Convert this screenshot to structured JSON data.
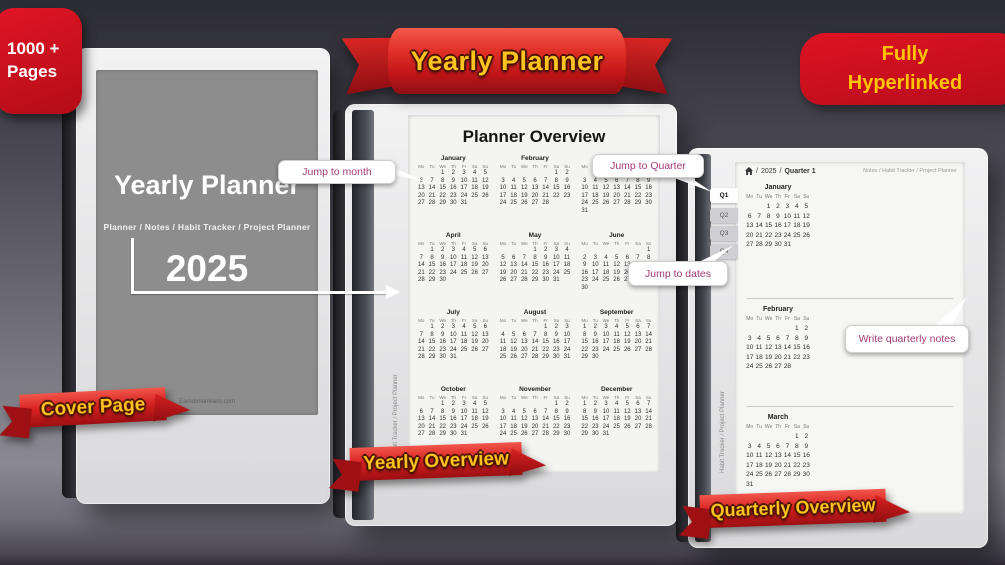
{
  "badge": {
    "line1": "1000 +",
    "line2": "Pages"
  },
  "banner": {
    "label": "Yearly Planner"
  },
  "hyperlink_badge": {
    "line1": "Fully",
    "line2": "Hyperlinked"
  },
  "callouts": {
    "jump_month": "Jump to month",
    "jump_quarter": "Jump to Quarter",
    "jump_dates": "Jump to dates",
    "write_notes": "Write quarterly notes"
  },
  "ribbons": {
    "cover": "Cover Page",
    "yearly": "Yearly Overview",
    "quarterly": "Quarterly Overview"
  },
  "cover": {
    "title": "Yearly Planner",
    "nav": "Planner  /  Notes  /  Habit Tracker  /  Project Planner",
    "year": "2025",
    "watermark": "Earndohanklass.com"
  },
  "overview": {
    "title": "Planner Overview",
    "side_text": "Habit Tracker  /  Project Planner"
  },
  "quarterly": {
    "year": "2025",
    "page": "Quarter 1",
    "sep": "/",
    "links": "Notes / Habit Tracker / Project Planner",
    "tabs": [
      "Q1",
      "Q2",
      "Q3",
      "Q4"
    ],
    "side_text": "Habit Tracker  /  Project Planner"
  },
  "weekdays": [
    "Mo",
    "Tu",
    "We",
    "Th",
    "Fr",
    "Sa",
    "Su"
  ],
  "months": [
    {
      "name": "January",
      "offset": 2,
      "days": 31
    },
    {
      "name": "February",
      "offset": 5,
      "days": 28
    },
    {
      "name": "March",
      "offset": 5,
      "days": 31
    },
    {
      "name": "April",
      "offset": 1,
      "days": 30
    },
    {
      "name": "May",
      "offset": 3,
      "days": 31
    },
    {
      "name": "June",
      "offset": 6,
      "days": 30
    },
    {
      "name": "July",
      "offset": 1,
      "days": 31
    },
    {
      "name": "August",
      "offset": 4,
      "days": 31
    },
    {
      "name": "September",
      "offset": 0,
      "days": 30
    },
    {
      "name": "October",
      "offset": 2,
      "days": 31
    },
    {
      "name": "November",
      "offset": 5,
      "days": 30
    },
    {
      "name": "December",
      "offset": 0,
      "days": 31
    }
  ],
  "colors": {
    "ribbon_red": "#d62020",
    "accent_yellow": "#ffc41f",
    "badge_red": "#cf1020",
    "callout_text": "#a23a78",
    "cover_screen_gray": "#8d8d8d"
  }
}
